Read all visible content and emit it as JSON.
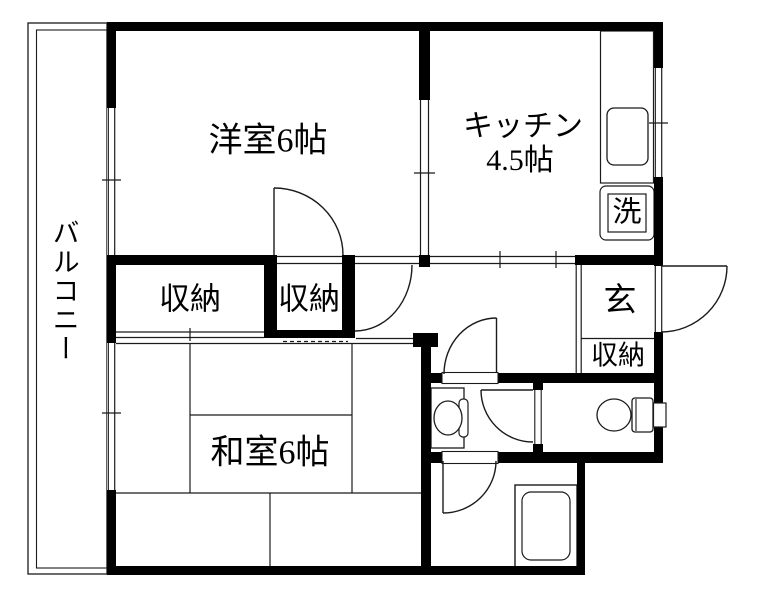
{
  "colors": {
    "wall": "#000000",
    "line": "#1b1b1b",
    "background": "#ffffff"
  },
  "floorplan": {
    "balcony": {
      "label": "バルコニー"
    },
    "western_room": {
      "label": "洋室6帖"
    },
    "kitchen": {
      "label_line1": "キッチン",
      "label_line2": "4.5帖"
    },
    "closet_west": {
      "label": "収納"
    },
    "closet_center": {
      "label": "収納"
    },
    "japanese_room": {
      "label": "和室6帖"
    },
    "entrance": {
      "label": "玄"
    },
    "entrance_closet": {
      "label": "収納"
    },
    "washing_machine": {
      "label": "洗"
    }
  }
}
